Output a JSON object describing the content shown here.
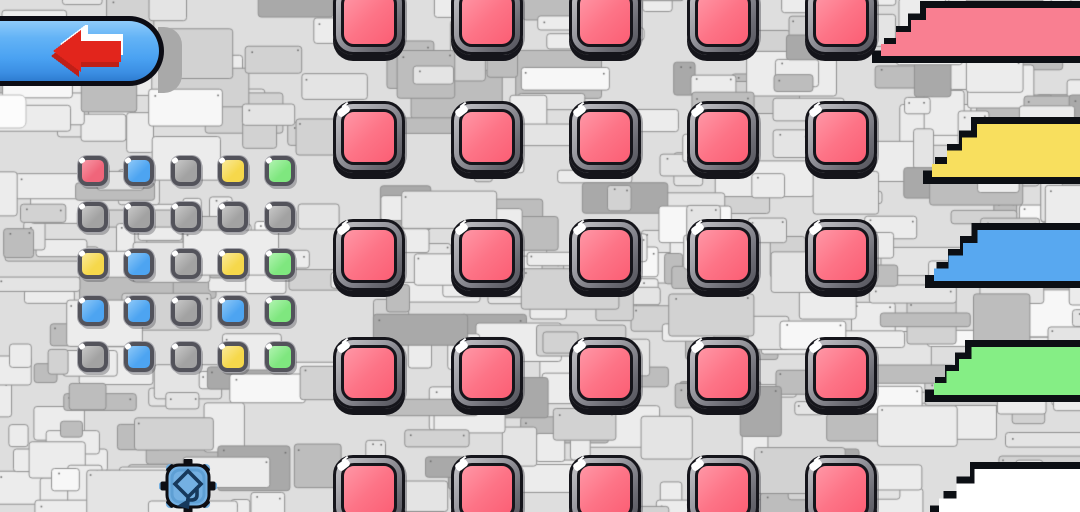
{
  "scene": {
    "title": "pixel stone puzzle level",
    "background": {
      "base": "#dedede",
      "tile_light": "#ececec",
      "tile_lighter": "#f7f7f7",
      "tile_mid": "#d2d2d2",
      "tile_dark": "#bdbdbd",
      "tile_darker": "#a9a9a9",
      "tile_border": "#909090",
      "white_tile": "#fcfcfc"
    }
  },
  "back_button": {
    "label": "back",
    "arrow_direction": "left",
    "pill_color": "#4aa2f2",
    "border_color": "#0c0c14",
    "arrow_color": "#e2251c",
    "arrow_shadow_color": "#bf1f17",
    "arrow_highlight_color": "#ffffff",
    "drop_shadow_color": "#a9a9a9"
  },
  "pattern_grid": {
    "rows": 5,
    "cols": 5,
    "cells": [
      [
        "red",
        "blue",
        "gray",
        "yellow",
        "green"
      ],
      [
        "gray",
        "gray",
        "gray",
        "gray",
        "gray"
      ],
      [
        "yellow",
        "blue",
        "gray",
        "yellow",
        "green"
      ],
      [
        "blue",
        "blue",
        "gray",
        "blue",
        "green"
      ],
      [
        "gray",
        "blue",
        "gray",
        "yellow",
        "green"
      ]
    ],
    "palette": {
      "red": {
        "fill": "#f0657a",
        "light": "#f899a7"
      },
      "blue": {
        "fill": "#4da4f1",
        "light": "#8fc9f8"
      },
      "gray": {
        "fill": "#a2a2a2",
        "light": "#c9c9c9"
      },
      "yellow": {
        "fill": "#f6d84b",
        "light": "#faea9b"
      },
      "green": {
        "fill": "#7fe77f",
        "light": "#b2f4b2"
      }
    }
  },
  "button_grid": {
    "rows": 5,
    "cols": 5,
    "button_color_name": "red",
    "fill": "#fb5e74",
    "fill_light": "#ff97a6",
    "ring_light": "#c6c6ca",
    "ring_dark": "#53535b",
    "outline": "#15151b"
  },
  "ramps": {
    "count": 5,
    "border_color": "#0c0f14",
    "items": [
      {
        "name": "pink",
        "fill": "#f97f91"
      },
      {
        "name": "yellow",
        "fill": "#f8df5e"
      },
      {
        "name": "blue",
        "fill": "#58a8f0"
      },
      {
        "name": "green",
        "fill": "#85ee85"
      },
      {
        "name": "white",
        "fill": "#ffffff"
      }
    ]
  },
  "enemy": {
    "name": "spike-mine",
    "body_color": "#74b0e2",
    "body_shade": "#5e9fd4",
    "outline": "#0d0d12",
    "glyph_color": "#17395c",
    "arrow_direction": "down-left"
  }
}
